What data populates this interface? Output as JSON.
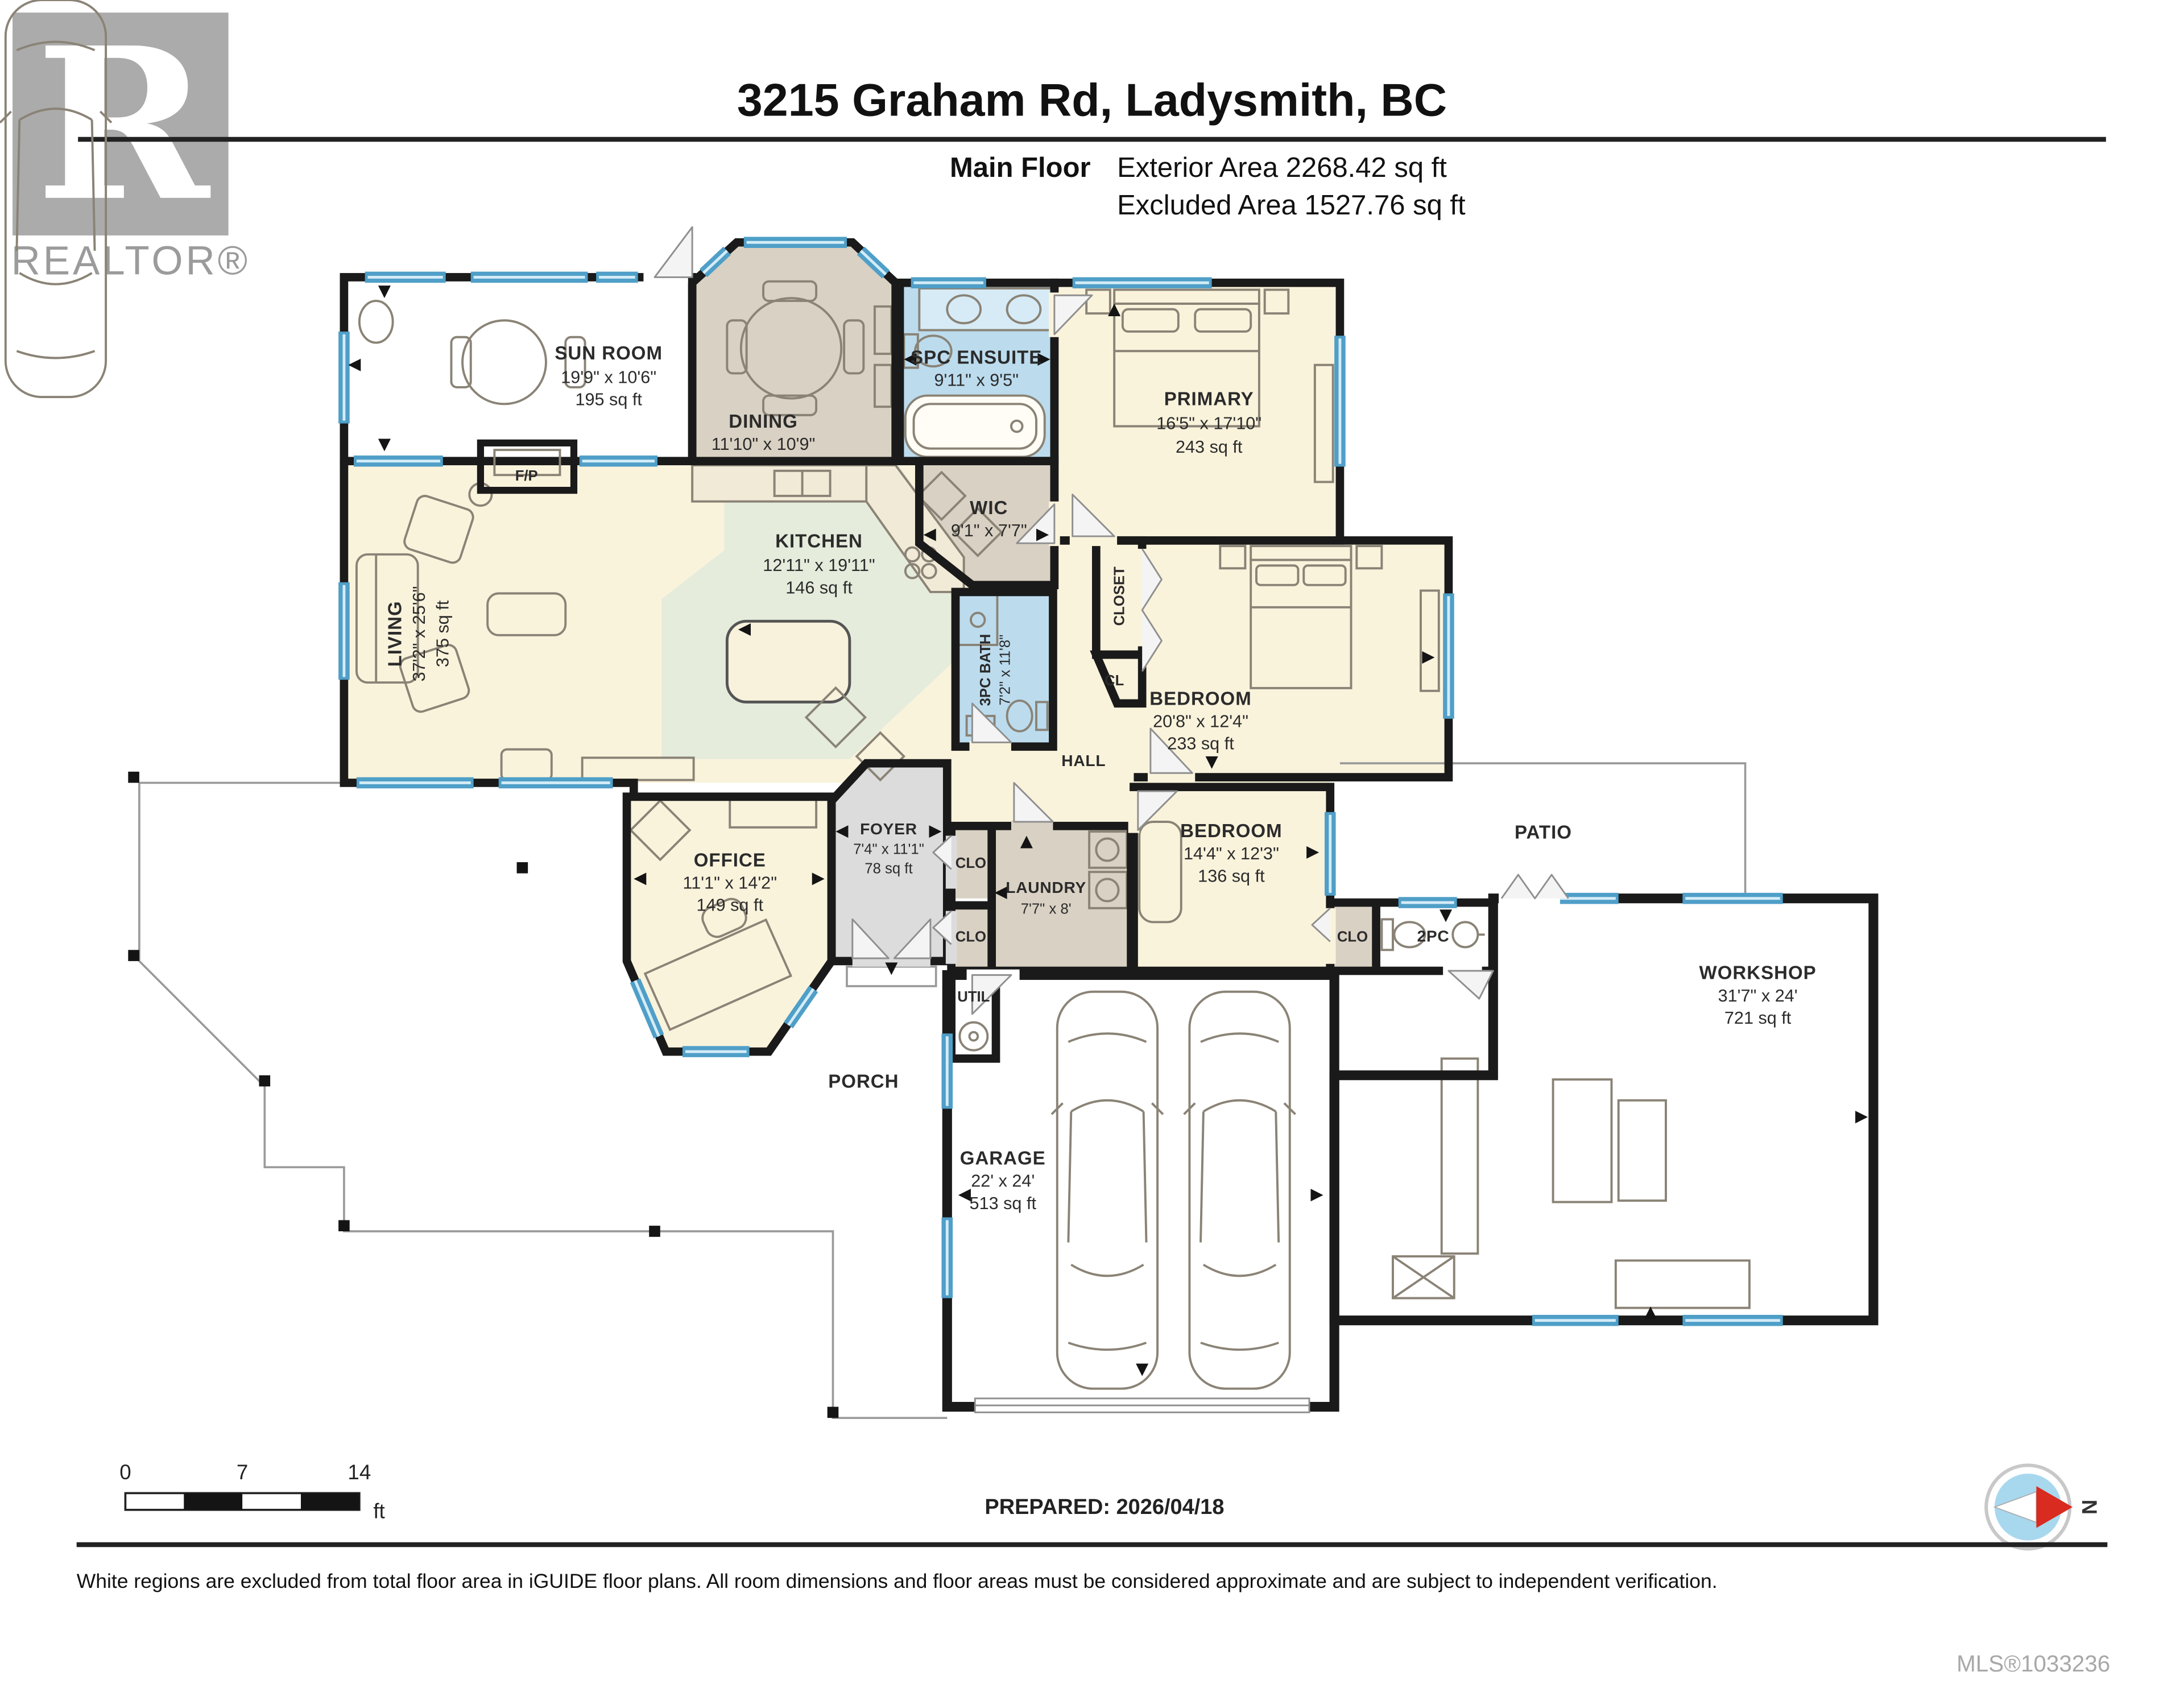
{
  "header": {
    "brand": {
      "logo_letter": "R",
      "logo_text": "REALTOR®"
    },
    "title": "3215 Graham Rd, Ladysmith, BC",
    "floor": {
      "label": "Main Floor",
      "exterior_area": "Exterior Area 2268.42 sq ft",
      "excluded_area": "Excluded Area 1527.76 sq ft"
    }
  },
  "rooms": {
    "sun_room": {
      "name": "SUN ROOM",
      "dims": "19'9\" x 10'6\"",
      "area": "195 sq ft"
    },
    "dining": {
      "name": "DINING",
      "dims": "11'10\" x 10'9\""
    },
    "spc_ensuite": {
      "name": "SPC ENSUITE",
      "dims": "9'11\" x 9'5\""
    },
    "primary": {
      "name": "PRIMARY",
      "dims": "16'5\" x 17'10\"",
      "area": "243 sq ft"
    },
    "wic": {
      "name": "WIC",
      "dims": "9'1\" x 7'7\""
    },
    "kitchen": {
      "name": "KITCHEN",
      "dims": "12'11\" x 19'11\"",
      "area": "146 sq ft"
    },
    "living": {
      "name": "LIVING",
      "dims": "37'2\" x 25'6\"",
      "area": "375 sq ft"
    },
    "bath_3pc": {
      "name": "3PC BATH",
      "dims": "7'2\" x 11'8\""
    },
    "bedroom_mid": {
      "name": "BEDROOM",
      "dims": "20'8\" x 12'4\"",
      "area": "233 sq ft"
    },
    "bedroom_front": {
      "name": "BEDROOM",
      "dims": "14'4\" x 12'3\"",
      "area": "136 sq ft"
    },
    "office": {
      "name": "OFFICE",
      "dims": "11'1\" x 14'2\"",
      "area": "149 sq ft"
    },
    "foyer": {
      "name": "FOYER",
      "dims": "7'4\" x 11'1\"",
      "area": "78 sq ft"
    },
    "laundry": {
      "name": "LAUNDRY",
      "dims": "7'7\" x 8'"
    },
    "garage": {
      "name": "GARAGE",
      "dims": "22' x 24'",
      "area": "513 sq ft"
    },
    "workshop": {
      "name": "WORKSHOP",
      "dims": "31'7\" x 24'",
      "area": "721 sq ft"
    },
    "patio": {
      "name": "PATIO"
    },
    "porch": {
      "name": "PORCH"
    },
    "hall": {
      "name": "HALL"
    },
    "fireplace": {
      "name": "F/P"
    },
    "util": {
      "name": "UTIL"
    },
    "bath_2pc": {
      "name": "2PC"
    },
    "closet": {
      "name": "CLOSET"
    },
    "cl": {
      "name": "CL"
    },
    "clo": {
      "name": "CLO"
    }
  },
  "footer": {
    "scale_bar": {
      "tick_0": "0",
      "tick_7": "7",
      "tick_14": "14",
      "unit": "ft"
    },
    "prepared": "PREPARED: 2026/04/18",
    "compass_north": "N",
    "disclaimer": "White regions are excluded from total floor area in iGUIDE floor plans. All room dimensions and floor areas must be considered approximate and are subject to independent verification.",
    "mls": "MLS®1033236"
  },
  "colors": {
    "floor_cream": "#faf3dc",
    "floor_tan": "#d9d1c3",
    "floor_blue": "#bcdcee",
    "floor_green": "#e5ecdc",
    "floor_gray": "#dcdcdc",
    "wall": "#1a1a1a",
    "window_blue": "#4f9fc8",
    "compass_red": "#d92b20",
    "logo_gray": "#ababab"
  }
}
